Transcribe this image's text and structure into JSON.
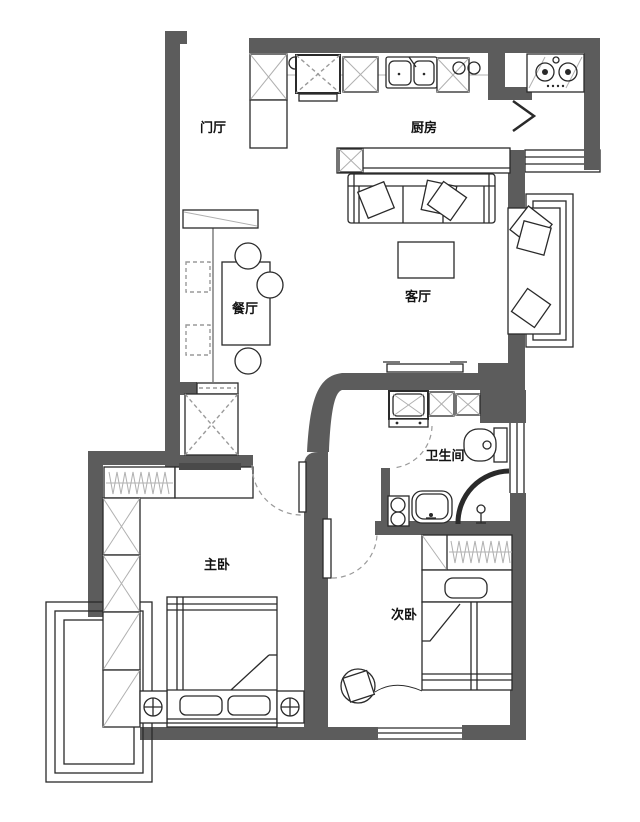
{
  "figure": {
    "kind": "apartment-floor-plan"
  },
  "colors": {
    "wall": "#5c5c5c",
    "line": "#2a2a2a",
    "light_line": "#b0b0b0",
    "dashed_line": "#9a9a9a",
    "label": "#111111",
    "background": "#ffffff"
  },
  "rooms": {
    "entry": {
      "label": "门厅"
    },
    "kitchen": {
      "label": "厨房"
    },
    "dining": {
      "label": "餐厅"
    },
    "living": {
      "label": "客厅"
    },
    "bathroom": {
      "label": "卫生间"
    },
    "master_bedroom": {
      "label": "主卧"
    },
    "second_bedroom": {
      "label": "次卧"
    }
  }
}
